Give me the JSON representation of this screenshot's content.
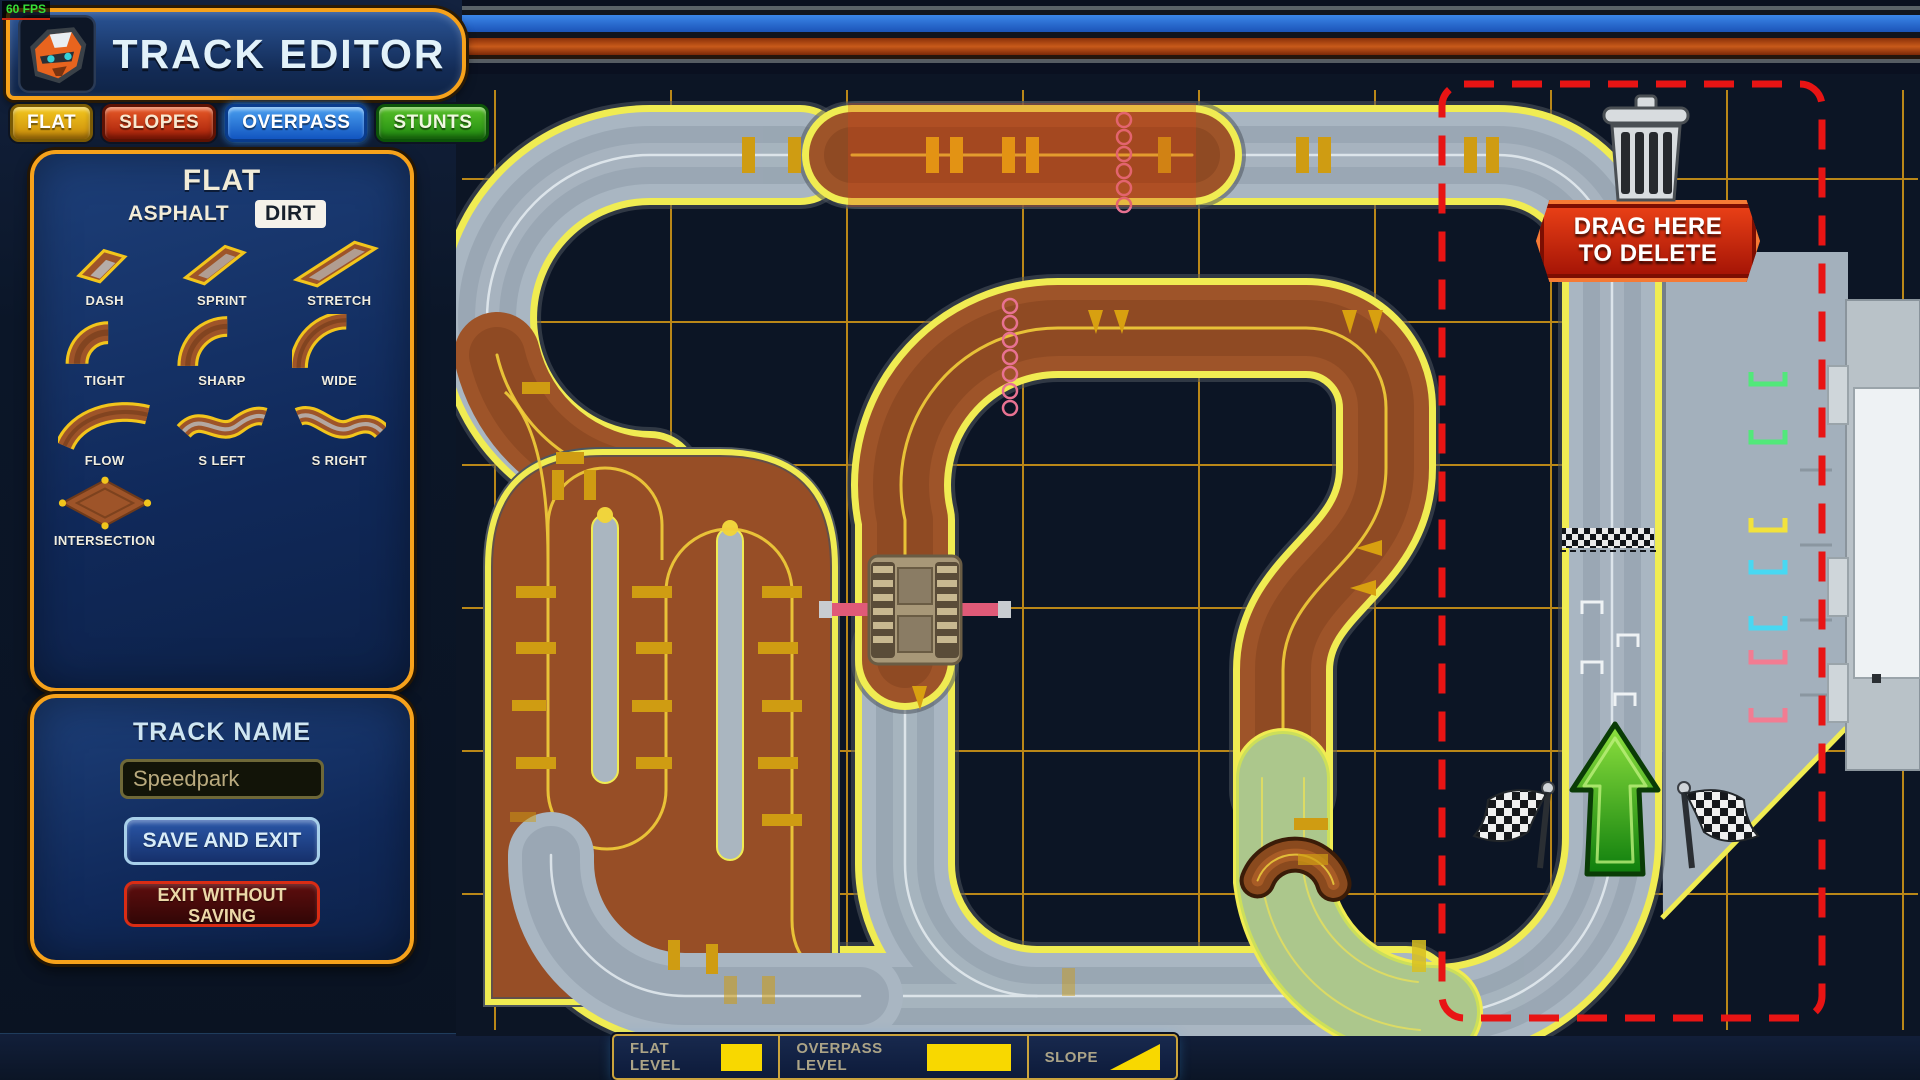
{
  "fps_label": "60 FPS",
  "header": {
    "title": "TRACK EDITOR",
    "logo": "badger-icon"
  },
  "tabs": [
    {
      "id": "flat",
      "label": "FLAT",
      "color": "#e8a50f"
    },
    {
      "id": "slopes",
      "label": "SLOPES",
      "color": "#c23410"
    },
    {
      "id": "overpass",
      "label": "OVERPASS",
      "color": "#1a6ad8"
    },
    {
      "id": "stunts",
      "label": "STUNTS",
      "color": "#2f9e16"
    }
  ],
  "palette": {
    "title": "FLAT",
    "surfaces": [
      "ASPHALT",
      "DIRT"
    ],
    "selected_surface": "DIRT",
    "pieces": [
      {
        "label": "DASH",
        "icon": "dash"
      },
      {
        "label": "SPRINT",
        "icon": "sprint"
      },
      {
        "label": "STRETCH",
        "icon": "stretch"
      },
      {
        "label": "TIGHT",
        "icon": "tight"
      },
      {
        "label": "SHARP",
        "icon": "sharp"
      },
      {
        "label": "WIDE",
        "icon": "wide"
      },
      {
        "label": "FLOW",
        "icon": "flow"
      },
      {
        "label": "S LEFT",
        "icon": "sleft"
      },
      {
        "label": "S RIGHT",
        "icon": "sright"
      },
      {
        "label": "INTERSECTION",
        "icon": "intersection"
      }
    ]
  },
  "track_form": {
    "label": "TRACK NAME",
    "name_value": "Speedpark",
    "save_label": "SAVE AND EXIT",
    "exit_label": "EXIT WITHOUT SAVING"
  },
  "delete_zone": {
    "line1": "DRAG HERE",
    "line2": "TO DELETE",
    "icon": "trash-icon"
  },
  "legend": [
    {
      "label": "FLAT LEVEL",
      "swatch": "square"
    },
    {
      "label": "OVERPASS LEVEL",
      "swatch": "bar"
    },
    {
      "label": "SLOPE",
      "swatch": "triangle"
    }
  ],
  "colors": {
    "accent_orange": "#f7a21b",
    "swatch_yellow": "#f8d800",
    "marquee_red": "#e81414",
    "asphalt_gray": "#a9b6c2",
    "dirt_brown": "#9e5429",
    "edge_yellow": "#f0ec52",
    "grid_orange": "#d99b16"
  }
}
